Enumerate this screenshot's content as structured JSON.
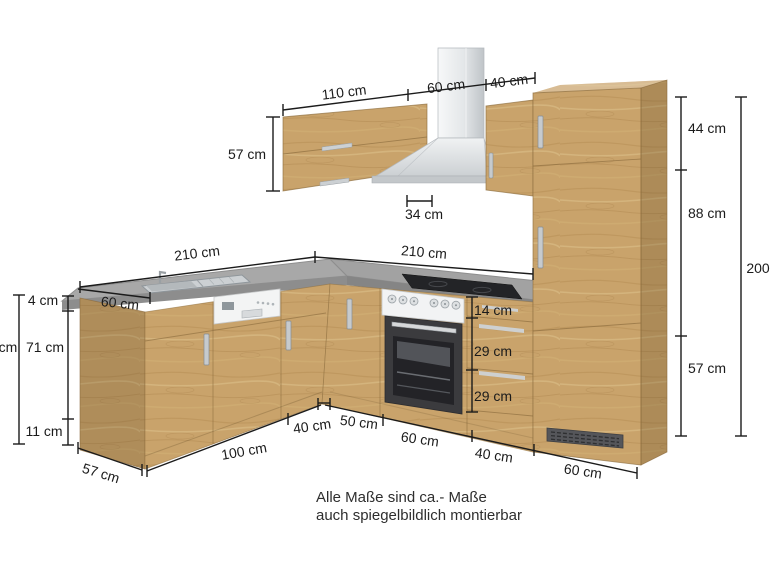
{
  "caption": {
    "line1": "Alle Maße sind ca.- Maße",
    "line2": "auch spiegelbildlich montierbar"
  },
  "dims": {
    "top_110": "110 cm",
    "top_60": "60 cm",
    "top_40": "40 cm",
    "wall_cab_height": "57 cm",
    "wall_cab_depth": "34 cm",
    "counter_left": "210 cm",
    "counter_right": "210 cm",
    "counter_depth": "60 cm",
    "left_worktop": "4 cm",
    "left_front": "71 cm",
    "left_plinth": "11 cm",
    "left_total_cut": "cm",
    "end_panel_depth": "57 cm",
    "floor_left_100": "100 cm",
    "floor_left_40": "40 cm",
    "floor_right_50": "50 cm",
    "floor_right_60_oven": "60 cm",
    "floor_right_40_drawers": "40 cm",
    "floor_right_60_tall": "60 cm",
    "drawer_top": "14 cm",
    "drawer_mid": "29 cm",
    "drawer_bottom": "29 cm",
    "tall_top": "44 cm",
    "tall_mid": "88 cm",
    "tall_bottom": "57 cm",
    "tall_total_cut": "200"
  },
  "colors": {
    "wood": "#c9a36b",
    "wood_dark": "#a98049",
    "wood_light": "#d8b780",
    "counter_top": "#a6a6a6",
    "counter_edge": "#8d8d8d",
    "steel": "#dfe2e4",
    "appliance_dark": "#3b3b3e",
    "dim_text": "#1b1b1b"
  }
}
